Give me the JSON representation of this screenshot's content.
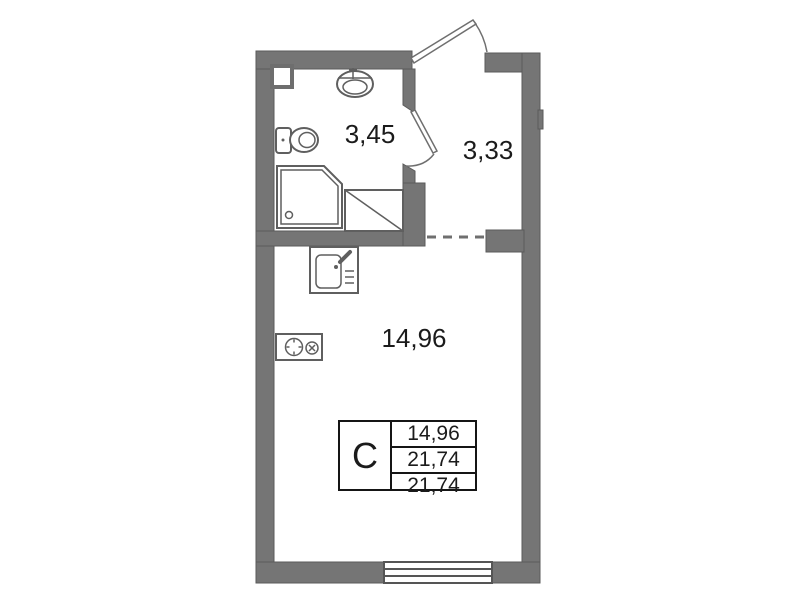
{
  "colors": {
    "wall-fill": "#757575",
    "wall-edge": "#5a5a5a",
    "fixture-line": "#5f5f5f",
    "door-line": "#6f6f6f",
    "text": "#1b1b1b",
    "table-border": "#151515",
    "page-bg": "#ffffff"
  },
  "floor_plan": {
    "unit_type_label": "С",
    "rooms": [
      {
        "id": "bathroom",
        "area": "3,45"
      },
      {
        "id": "hallway",
        "area": "3,33"
      },
      {
        "id": "living-kitchen",
        "area": "14,96"
      }
    ],
    "info_table": {
      "type": "С",
      "rows": [
        {
          "value": "14,96"
        },
        {
          "value": "21,74"
        },
        {
          "value": "21,74"
        }
      ]
    },
    "fixtures": [
      "wash-basin",
      "toilet",
      "shower-tray",
      "appliance-space",
      "kitchen-sink",
      "stove",
      "window",
      "entrance-door",
      "bathroom-door",
      "dashed-opening",
      "wall-pilaster"
    ]
  }
}
